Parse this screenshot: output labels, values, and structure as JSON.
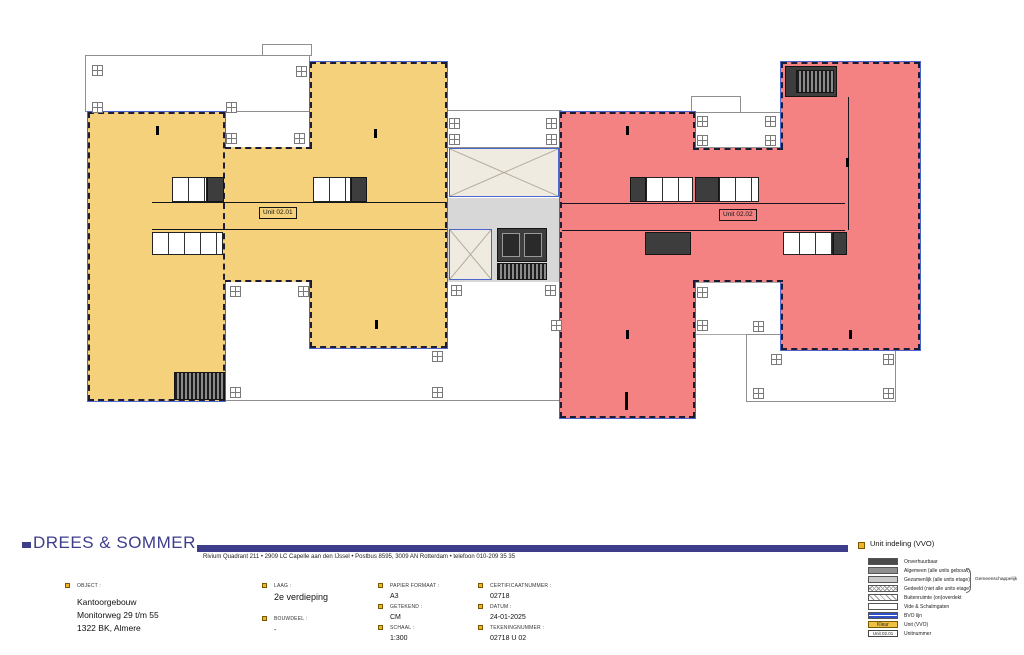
{
  "plan": {
    "unit1_label": "Unit 02.01",
    "unit2_label": "Unit 02.02"
  },
  "legend": {
    "title": "Unit indeling (VVO)",
    "group_label": "Gemeenschappelijk",
    "items": [
      {
        "label": "Onverhuurbaar"
      },
      {
        "label": "Algemeen (alle units gebouw)"
      },
      {
        "label": "Gezamenlijk (alle units etage)"
      },
      {
        "label": "Gedeeld (niet alle units etage)"
      },
      {
        "label": "Buitenruimte (on)overdekt"
      },
      {
        "label": "Vide & Schalmgaten"
      },
      {
        "label": "BVO lijn"
      },
      {
        "label": "Unit (VVO)",
        "swatch_text": "Kleur"
      },
      {
        "label": "Unitnummer",
        "swatch_text": "Unit 02.01"
      }
    ]
  },
  "titleblock": {
    "logo_text": "DREES & SOMMER",
    "address_line": "Rivium Quadrant 211   •   2909 LC Capelle aan den IJssel   •   Postbus 8595, 3009 AN Rotterdam   •   telefoon 010-209 35 35",
    "object": {
      "label": "OBJECT :",
      "line1": "Kantoorgebouw",
      "line2": "Monitorweg 29 t/m 55",
      "line3": "1322 BK, Almere"
    },
    "laag": {
      "label": "LAAG :",
      "value": "2e verdieping"
    },
    "bouwdeel": {
      "label": "BOUWDEEL :",
      "value": "-"
    },
    "papier_formaat": {
      "label": "PAPIER FORMAAT :",
      "value": "A3"
    },
    "getekend": {
      "label": "GETEKEND :",
      "value": "CM"
    },
    "schaal": {
      "label": "SCHAAL :",
      "value": "1:300"
    },
    "certificaatnummer": {
      "label": "CERTIFICAATNUMMER :",
      "value": "02718"
    },
    "datum": {
      "label": "DATUM :",
      "value": "24-01-2025"
    },
    "tekeningnummer": {
      "label": "TEKENINGNUMMER :",
      "value": "02718 U 02"
    }
  },
  "colors": {
    "unit_yellow": "#F5D17C",
    "unit_red": "#F58282",
    "logo_navy": "#3D3D8C",
    "field_square_yellow": "#F0B428",
    "bvo_blue": "#3050C8"
  }
}
